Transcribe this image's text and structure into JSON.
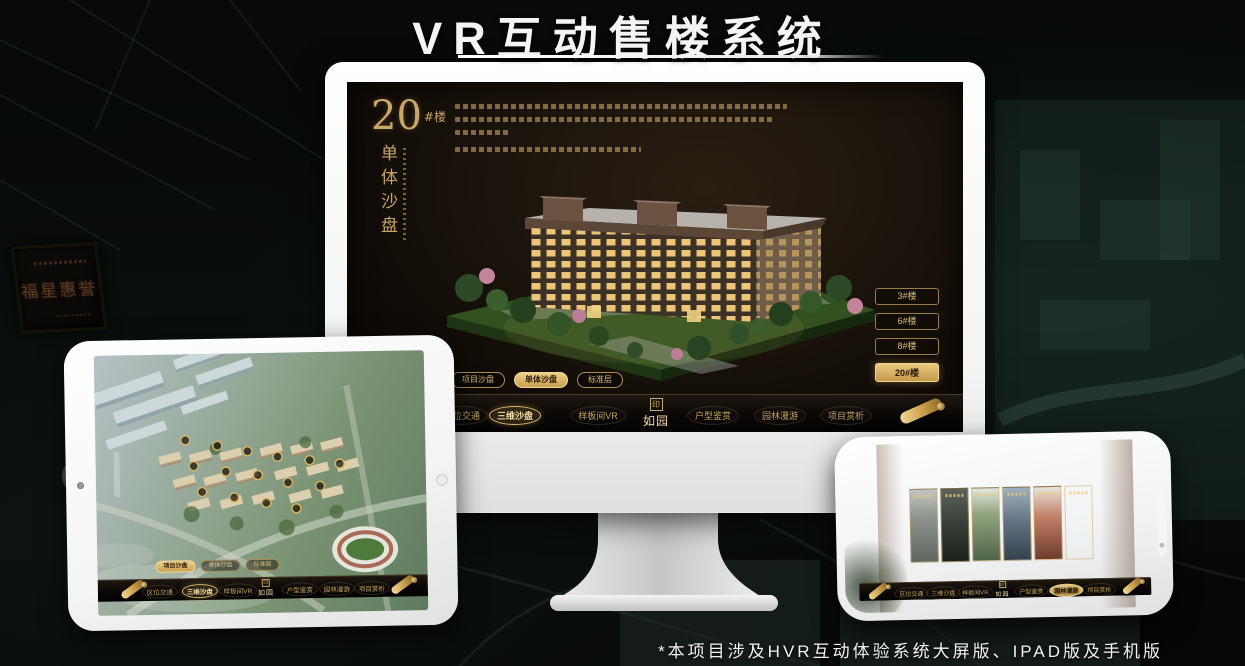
{
  "page": {
    "title": "VR互动售楼系统",
    "footnote": "*本项目涉及HVR互动体验系统大屏版、IPAD版及手机版",
    "plaque_text": "福星惠誉"
  },
  "brand": {
    "logo": "如园",
    "seal_char": "印"
  },
  "colors": {
    "gold": "#c9a468",
    "gold_bright": "#e9c87f",
    "screen_bg": "#1a130b",
    "accent_white": "#f4f4f4"
  },
  "nav_items": {
    "item1": "区位交通",
    "item2": "三维沙盘",
    "item3": "样板间VR",
    "item4": "户型鉴赏",
    "item5": "园林漫游",
    "item6": "项目赏析"
  },
  "submenu": {
    "item1": "项目沙盘",
    "item2": "单体沙盘",
    "item3": "标准层"
  },
  "monitor": {
    "heading_number": "20",
    "heading_suffix": "#楼",
    "heading_vertical": "单体沙盘",
    "floor_buttons": [
      "3#楼",
      "6#楼",
      "8#楼",
      "20#楼"
    ],
    "active_floor": "20#楼",
    "active_submenu": "单体沙盘",
    "active_nav": "三维沙盘"
  },
  "tablet": {
    "active_submenu": "项目沙盘",
    "active_nav": "三维沙盘"
  },
  "phone": {
    "active_nav": "园林漫游",
    "gallery_card_count": 6
  }
}
